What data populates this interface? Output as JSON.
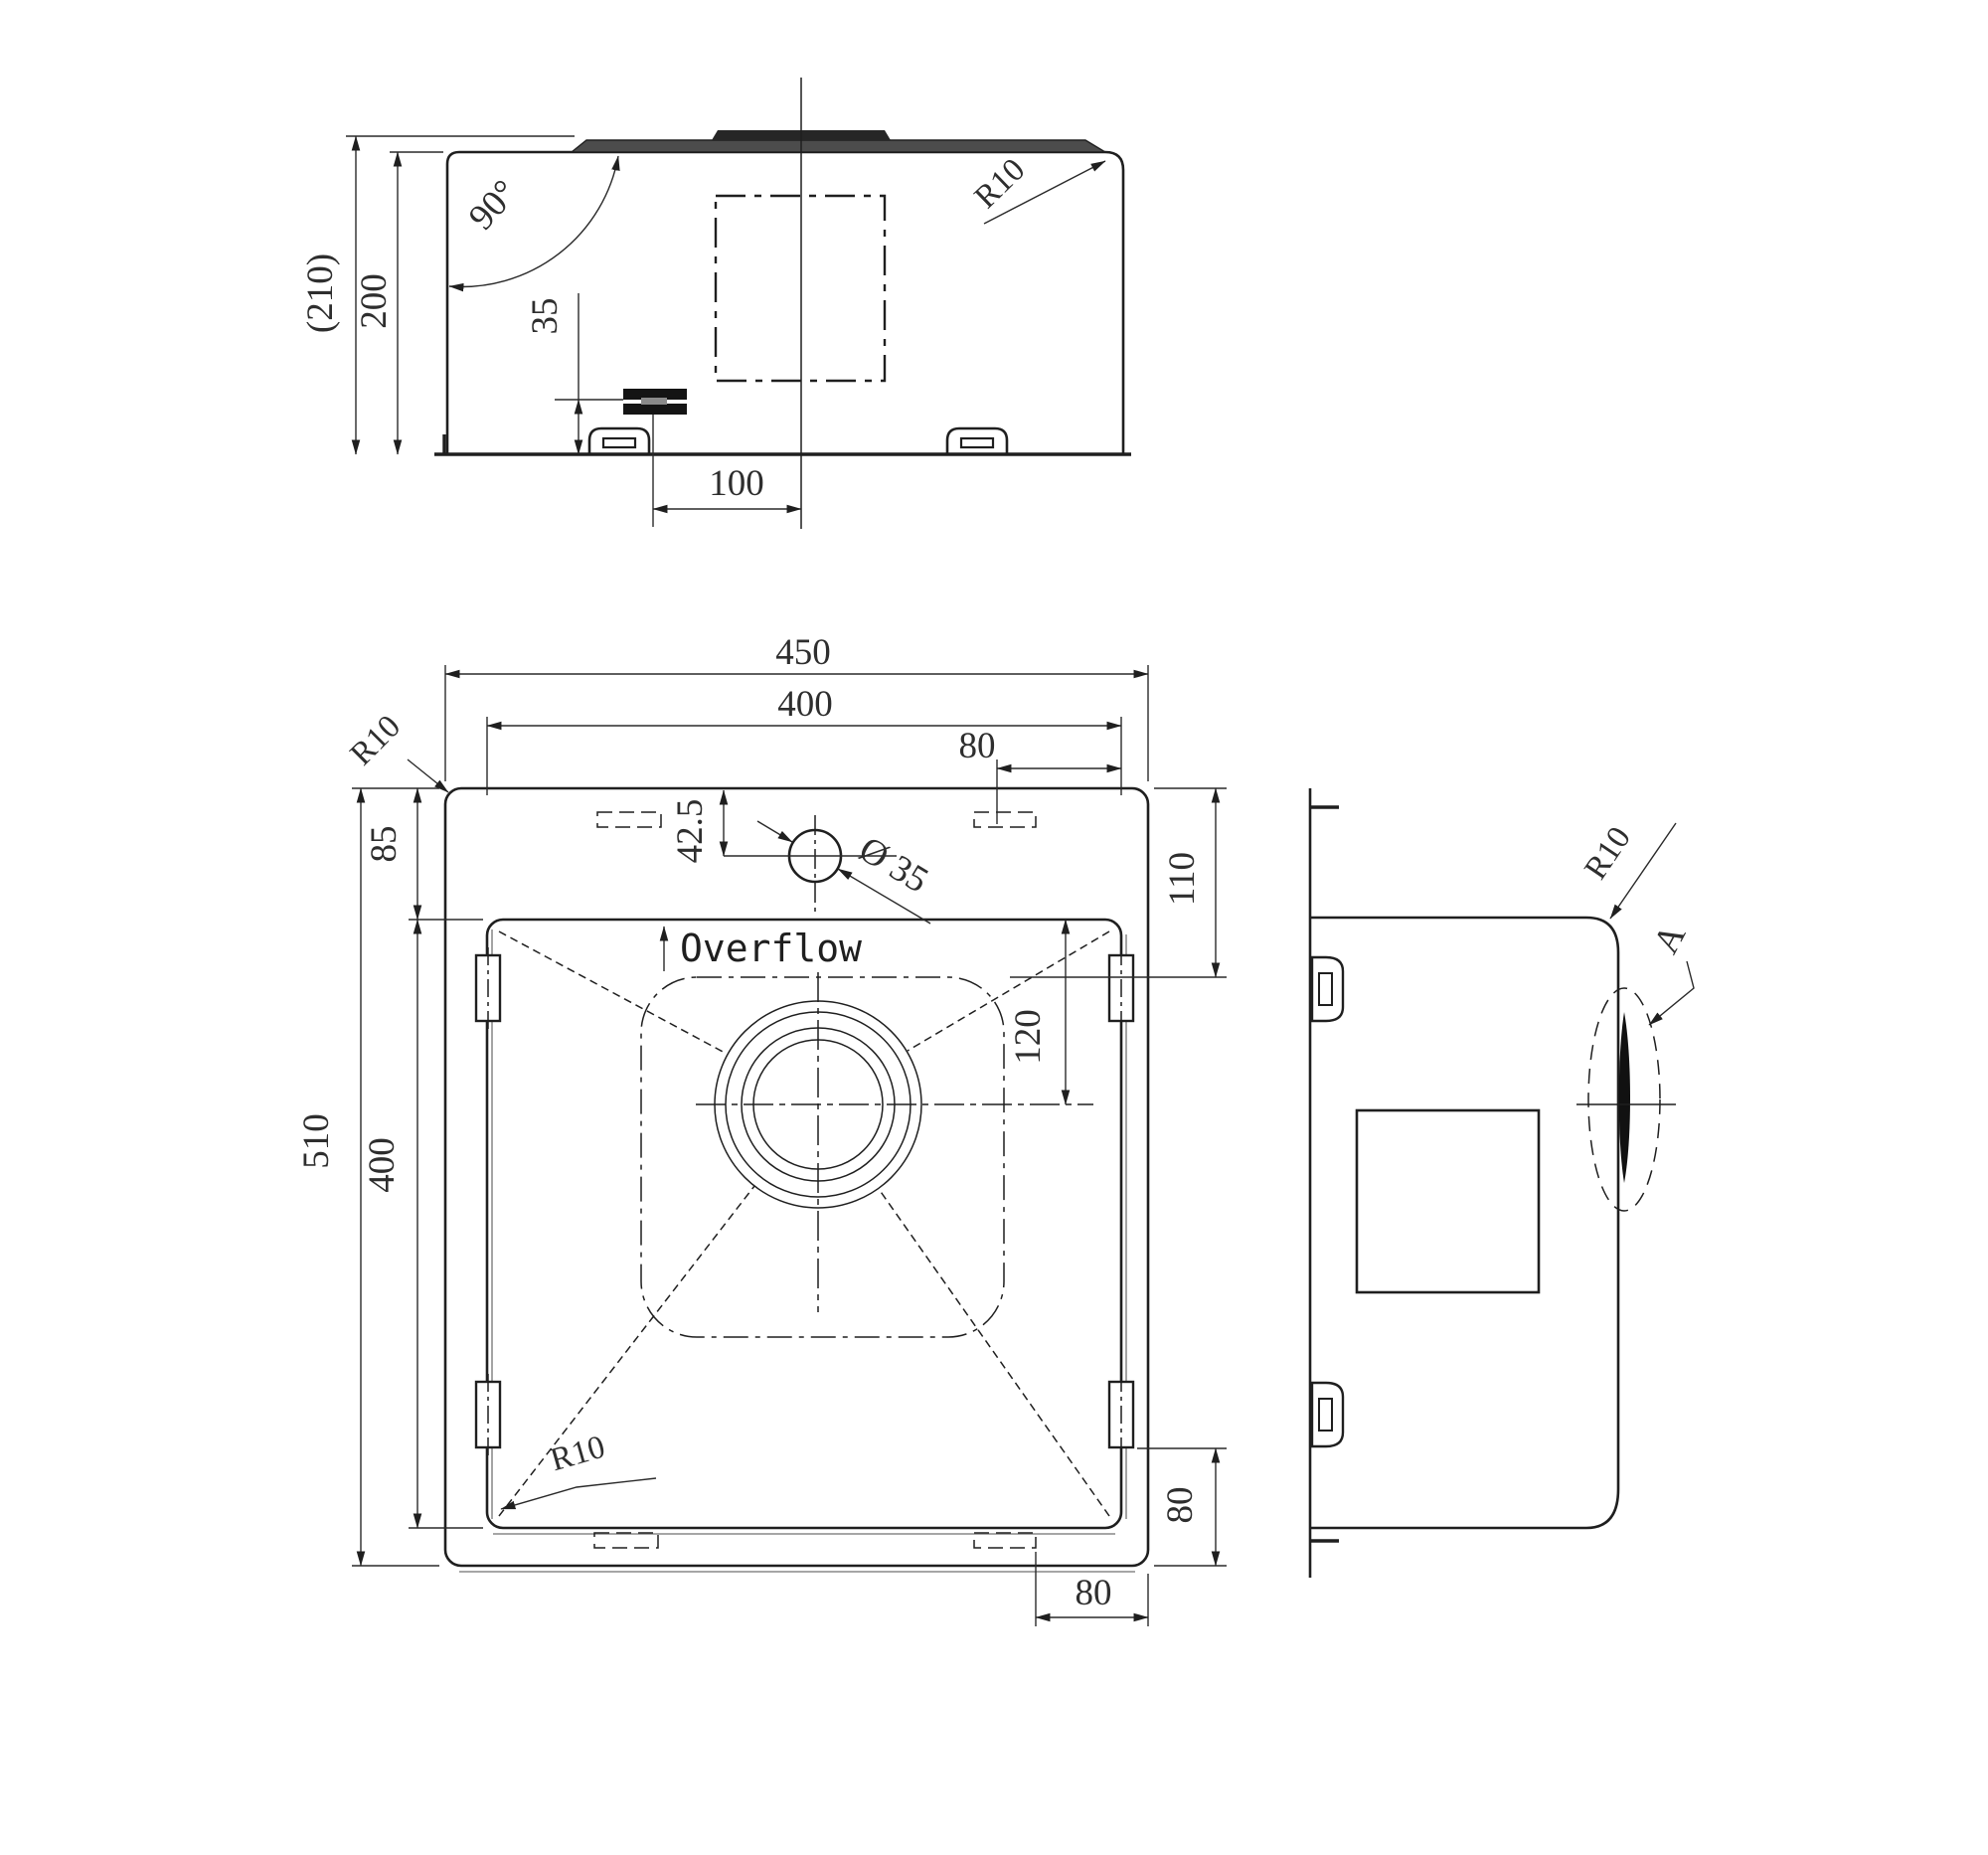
{
  "meta": {
    "ink_color": "#1f1f1f",
    "echo_color": "#9a9a9a",
    "background": "#ffffff"
  },
  "drawing": {
    "front_view": {
      "dims": {
        "overall_height": "(210)",
        "bowl_height": "200",
        "wall_angle": "90°",
        "clamp_height": "35",
        "clamp_offset": "100",
        "corner_radius": "R10"
      }
    },
    "plan_view": {
      "dims": {
        "overall_width": "450",
        "bowl_width": "400",
        "top_cutout_offset": "80",
        "corner_radius_rim": "R10",
        "rim_front": "85",
        "faucet_offset": "42.5",
        "faucet_diameter": "Ø 35",
        "rim_right_top": "110",
        "overflow_label": "Overflow",
        "drain_offset": "120",
        "overall_length": "510",
        "bowl_length": "400",
        "corner_radius_bowl": "R10",
        "rim_right_bottom": "80",
        "bottom_cutout_offset": "80"
      }
    },
    "side_view": {
      "dims": {
        "corner_radius": "R10",
        "detail_label": "A"
      }
    }
  }
}
